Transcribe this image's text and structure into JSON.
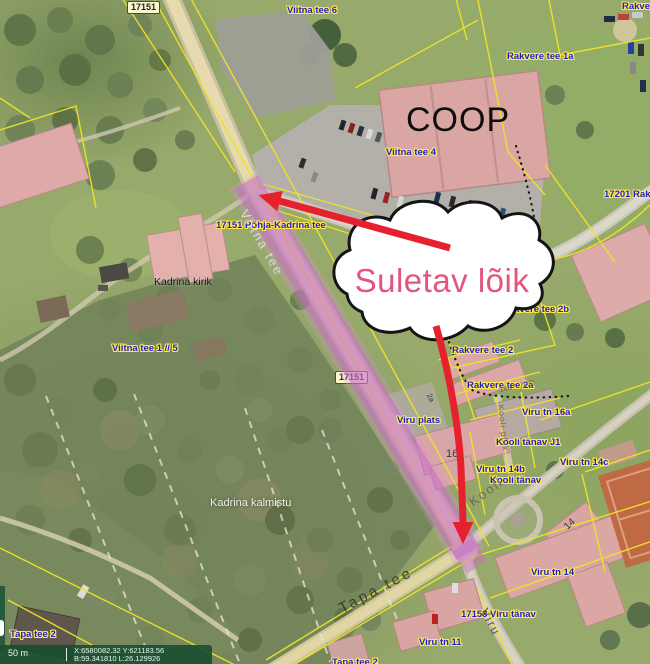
{
  "map_title": "Kadrina aerial cadastral map",
  "annotation": {
    "callout_text": "Suletav lõik",
    "callout_text_color": "#e4557e",
    "arrow_color": "#e6212e",
    "closed_section_color": "#c76bc5",
    "cadastral_line_color": "#ede426",
    "label_color": "#1f1fd0"
  },
  "road_badges": {
    "top": "17151",
    "mid": "17151"
  },
  "cadastral_labels": {
    "viitna_tee_6": "Viitna tee 6",
    "rakvere_corner": "Rakvere tee",
    "rakvere_tee_1a": "Rakvere tee 1a",
    "viitna_tee_4": "Viitna tee 4",
    "rakvere_17201": "17201 Rakvere tee",
    "pohja_kadrina": "17151 Põhja-Kadrina tee",
    "viitna_tee_1_5": "Viitna tee 1 // 5",
    "rakvere_tee_2b": "Rakvere tee 2b",
    "rakvere_tee_2": "Rakvere tee 2",
    "rakvere_tee_2a": "Rakvere tee 2a",
    "viru_plats": "Viru plats",
    "viru_tn_16a": "Viru tn 16a",
    "kooli_tanav_j1": "Kooli tänav J1",
    "viru_tn_14c": "Viru tn 14c",
    "viru_tn_14b": "Viru tn 14b",
    "kooli_tanav": "Kooli tänav",
    "viru_tn_14": "Viru tn 14",
    "viru_17153": "17153 Viru tänav",
    "viru_tn_11": "Viru tn 11",
    "tapa_tee_2": "Tapa tee 2",
    "tapa_tee_2_bottom": "Tapa tee 2"
  },
  "place_labels": {
    "coop": "COOP",
    "church": "Kadrina kirik",
    "cemetery": "Kadrina kalmistu"
  },
  "street_names": {
    "viitna": "Viitna tee",
    "tapa": "Tapa tee",
    "viru": "Viru",
    "kooli": "Kooli",
    "kooli_poik": "Kooli põik"
  },
  "building_numbers": {
    "school": "16",
    "b14": "14",
    "b2": "2",
    "b2a": "2a",
    "b16a": "16a",
    "b16b": "16b"
  },
  "statusbar": {
    "scale_label": "50 m",
    "coords_line1": "X:6580082.32 Y:621183.56",
    "coords_line2": "B:59.341810 L:26.129926"
  }
}
